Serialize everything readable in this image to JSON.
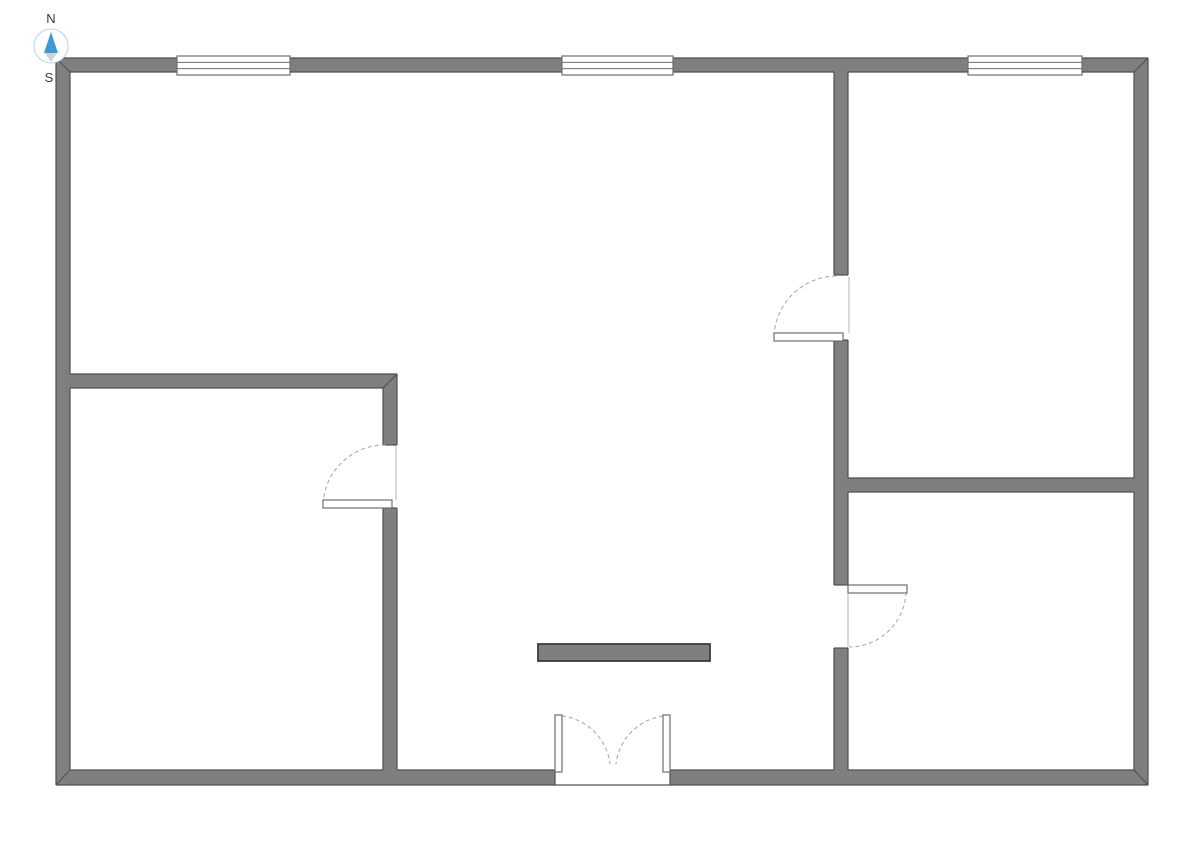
{
  "title": "Floor plan",
  "colors": {
    "background": "#ffffff",
    "wall_fill": "#7f7f7f",
    "wall_outline": "#4f4f4f",
    "island_outline": "#3c3c3c",
    "fixture_stroke": "#6e6e6e",
    "fixture_fill": "#ffffff",
    "arc_stroke": "#a3a3a3",
    "face_line": "#b5b5b5",
    "compass_north": "#3f97d4",
    "compass_south": "#ccd2d6",
    "compass_ring": "#b5d5ea",
    "label_color": "#3a3a3a"
  },
  "compass": {
    "north_label": "N",
    "south_label": "S"
  },
  "floorplan": {
    "width": 1191,
    "height": 841,
    "walls": [
      {
        "name": "outer-wall-top",
        "x": 56,
        "y": 58,
        "w": 1092,
        "h": 14
      },
      {
        "name": "outer-wall-bottom-left",
        "x": 56,
        "y": 770,
        "w": 499,
        "h": 15
      },
      {
        "name": "outer-wall-bottom-right",
        "x": 670,
        "y": 770,
        "w": 478,
        "h": 15
      },
      {
        "name": "outer-wall-left",
        "x": 56,
        "y": 58,
        "w": 14,
        "h": 727
      },
      {
        "name": "outer-wall-right",
        "x": 1134,
        "y": 58,
        "w": 14,
        "h": 727
      },
      {
        "name": "interior-wall-horizontal-left",
        "x": 70,
        "y": 374,
        "w": 327,
        "h": 14
      },
      {
        "name": "interior-wall-vertical-left-upper",
        "x": 383,
        "y": 374,
        "w": 14,
        "h": 71
      },
      {
        "name": "interior-wall-vertical-left-lower",
        "x": 383,
        "y": 508,
        "w": 14,
        "h": 262
      },
      {
        "name": "interior-wall-vertical-right-seg1",
        "x": 834,
        "y": 72,
        "w": 14,
        "h": 203
      },
      {
        "name": "interior-wall-vertical-right-seg2",
        "x": 834,
        "y": 340,
        "w": 14,
        "h": 245
      },
      {
        "name": "interior-wall-vertical-right-seg3",
        "x": 834,
        "y": 648,
        "w": 14,
        "h": 122
      },
      {
        "name": "interior-wall-horizontal-right",
        "x": 848,
        "y": 478,
        "w": 286,
        "h": 14
      }
    ],
    "outline_segments": [
      [
        56,
        58,
        1148,
        58
      ],
      [
        1148,
        58,
        1148,
        785
      ],
      [
        1148,
        785,
        56,
        785
      ],
      [
        56,
        785,
        56,
        58
      ],
      [
        70,
        72,
        834,
        72
      ],
      [
        848,
        72,
        1134,
        72
      ],
      [
        70,
        770,
        383,
        770
      ],
      [
        397,
        770,
        555,
        770
      ],
      [
        670,
        770,
        834,
        770
      ],
      [
        848,
        770,
        1134,
        770
      ],
      [
        555,
        770,
        555,
        785
      ],
      [
        670,
        770,
        670,
        785
      ],
      [
        70,
        72,
        70,
        374
      ],
      [
        70,
        388,
        70,
        770
      ],
      [
        1134,
        72,
        1134,
        478
      ],
      [
        1134,
        492,
        1134,
        770
      ],
      [
        70,
        374,
        397,
        374
      ],
      [
        70,
        388,
        383,
        388
      ],
      [
        383,
        388,
        383,
        445
      ],
      [
        383,
        508,
        383,
        770
      ],
      [
        397,
        374,
        397,
        445
      ],
      [
        397,
        508,
        397,
        770
      ],
      [
        383,
        445,
        397,
        445
      ],
      [
        383,
        508,
        397,
        508
      ],
      [
        834,
        72,
        834,
        275
      ],
      [
        834,
        340,
        834,
        585
      ],
      [
        834,
        648,
        834,
        770
      ],
      [
        848,
        72,
        848,
        275
      ],
      [
        848,
        340,
        848,
        478
      ],
      [
        848,
        492,
        848,
        585
      ],
      [
        848,
        648,
        848,
        770
      ],
      [
        834,
        275,
        848,
        275
      ],
      [
        834,
        340,
        848,
        340
      ],
      [
        834,
        585,
        848,
        585
      ],
      [
        834,
        648,
        848,
        648
      ],
      [
        848,
        478,
        1134,
        478
      ],
      [
        848,
        492,
        1134,
        492
      ]
    ],
    "miter_lines": [
      [
        56,
        58,
        70,
        72
      ],
      [
        1148,
        58,
        1134,
        72
      ],
      [
        1148,
        785,
        1134,
        770
      ],
      [
        56,
        785,
        70,
        770
      ],
      [
        397,
        374,
        383,
        388
      ]
    ],
    "windows": [
      {
        "name": "window-top-left",
        "x": 177,
        "y": 56,
        "w": 113,
        "h": 19
      },
      {
        "name": "window-top-middle",
        "x": 562,
        "y": 56,
        "w": 111,
        "h": 19
      },
      {
        "name": "window-top-right",
        "x": 968,
        "y": 56,
        "w": 114,
        "h": 19
      }
    ],
    "door_leaves": [
      {
        "name": "door-leaf-upper-right-room",
        "x": 774,
        "y": 333,
        "w": 69,
        "h": 8
      },
      {
        "name": "door-leaf-lower-left-room",
        "x": 323,
        "y": 500,
        "w": 69,
        "h": 8
      },
      {
        "name": "door-leaf-lower-right-room",
        "x": 848,
        "y": 585,
        "w": 59,
        "h": 8
      },
      {
        "name": "double-door-leaf-left",
        "x": 555,
        "y": 715,
        "w": 7,
        "h": 57
      },
      {
        "name": "double-door-leaf-right",
        "x": 663,
        "y": 715,
        "w": 7,
        "h": 57
      }
    ],
    "door_arcs": [
      {
        "name": "door-swing-arc-upper-right-room",
        "d": "M 774 336 A 63 63 0 0 1 837 276"
      },
      {
        "name": "door-swing-arc-lower-left-room",
        "d": "M 323 504 A 62 62 0 0 1 387 445"
      },
      {
        "name": "door-swing-arc-lower-right-room",
        "d": "M 906 592 A 57 57 0 0 1 849 647"
      },
      {
        "name": "double-door-swing-arc-left",
        "d": "M 562 716 A 55 55 0 0 1 610 764"
      },
      {
        "name": "double-door-swing-arc-right",
        "d": "M 663 716 A 55 55 0 0 0 616 764"
      }
    ],
    "face_lines": [
      [
        849,
        277,
        849,
        333
      ],
      [
        396,
        446,
        396,
        500
      ],
      [
        848,
        594,
        848,
        647
      ]
    ],
    "island": {
      "name": "freestanding-wall-segment",
      "x": 538,
      "y": 644,
      "w": 172,
      "h": 17
    }
  }
}
